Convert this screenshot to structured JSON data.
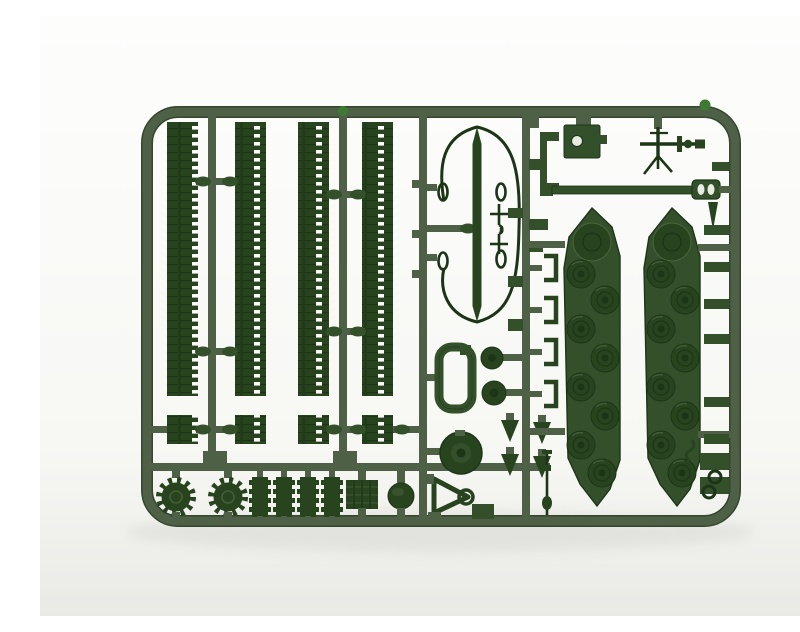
{
  "image": {
    "type": "product-photo",
    "subject": "Dark green injection-molded plastic model kit sprue with tank parts on a white backdrop",
    "orientation": "landscape"
  },
  "colors": {
    "background": "#fcfcfa",
    "background_low": "#ececе9",
    "runner": "#4e6045",
    "runner_dark": "#35462e",
    "part_dark": "#28441f",
    "part_darker": "#1c3517",
    "part_mid": "#33502a",
    "part_light": "#4c653e",
    "hole_light": "#e9ece2",
    "gate_green": "#3f7a35",
    "shadow": "#d9d9d5"
  },
  "parts_inventory": {
    "track_strips": {
      "label": "Long track-link strips",
      "count": 4
    },
    "track_segments": {
      "label": "Short track sections",
      "count": 4
    },
    "hull_panels": {
      "label": "Hull side panels with molded road wheels",
      "count": 2
    },
    "drive_sprockets": {
      "label": "Toothed drive sprocket wheels",
      "count": 2
    },
    "ribbed_rollers": {
      "label": "Ribbed return rollers",
      "count": 4
    },
    "engine_grille": {
      "label": "Engine grille plate",
      "count": 1
    },
    "idler_dome": {
      "label": "Domed idler wheel",
      "count": 1
    },
    "turret_ring": {
      "label": "Turret ring disc",
      "count": 1
    },
    "hatch_frame": {
      "label": "Open hatch frame",
      "count": 1
    },
    "round_hatches": {
      "label": "Round hatch covers",
      "count": 2
    },
    "tow_cable": {
      "label": "Tow cable loop with eyelets",
      "count": 1
    },
    "barrel_spindle": {
      "label": "Long barrel / torsion-bar spindle",
      "count": 1
    },
    "gun_barrel": {
      "label": "Main gun barrel with muzzle block",
      "count": 1
    },
    "machine_gun": {
      "label": "Anti-aircraft machine gun",
      "count": 1
    },
    "mounting_box": {
      "label": "Mount box with through-hole",
      "count": 1
    },
    "linkage": {
      "label": "Triangular linkage with ring",
      "count": 1
    },
    "small_fittings": {
      "label": "Hooks, brackets, cones and stub fittings",
      "count": 24
    }
  }
}
